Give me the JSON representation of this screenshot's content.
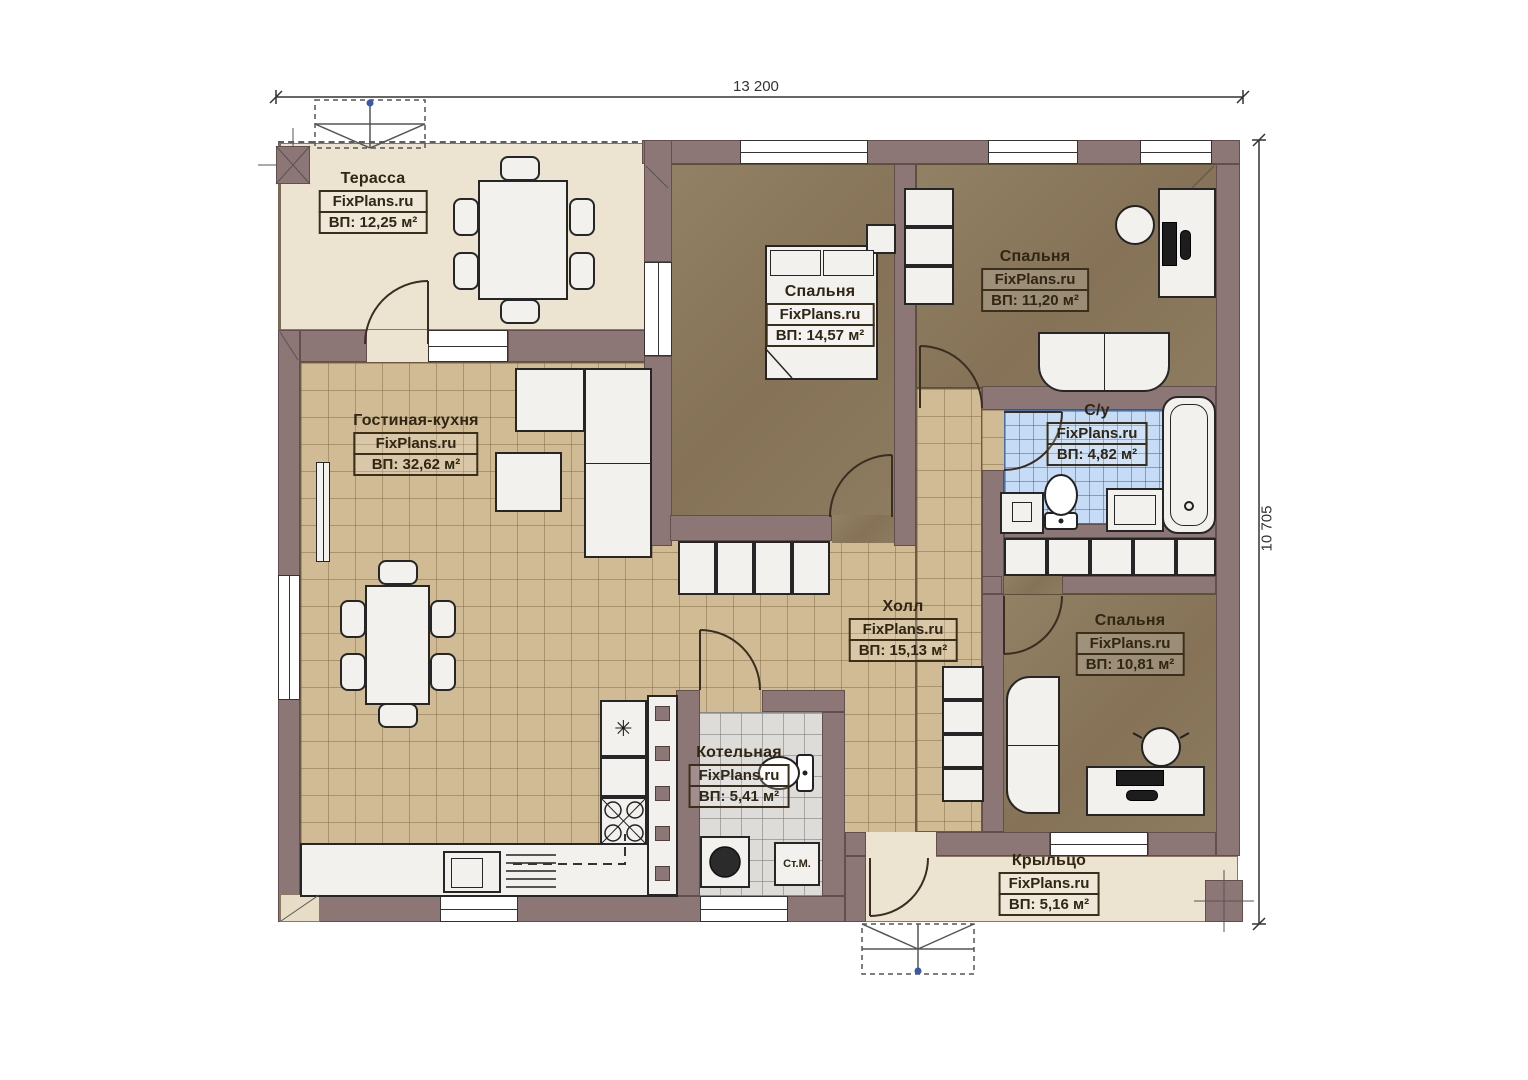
{
  "plan": {
    "watermark": "FixPlans.ru",
    "dimensions": {
      "width": "13 200",
      "height": "10 705"
    },
    "rooms": [
      {
        "key": "terrace",
        "name": "Терасса",
        "area": "ВП: 12,25 м²"
      },
      {
        "key": "living_kitchen",
        "name": "Гостиная-кухня",
        "area": "ВП: 32,62 м²"
      },
      {
        "key": "bedroom_1",
        "name": "Спальня",
        "area": "ВП: 14,57 м²"
      },
      {
        "key": "bedroom_2",
        "name": "Спальня",
        "area": "ВП: 11,20 м²"
      },
      {
        "key": "bathroom",
        "name": "С/у",
        "area": "ВП: 4,82 м²"
      },
      {
        "key": "hall",
        "name": "Холл",
        "area": "ВП: 15,13 м²"
      },
      {
        "key": "bedroom_3",
        "name": "Спальня",
        "area": "ВП: 10,81 м²"
      },
      {
        "key": "boiler_room",
        "name": "Котельная",
        "area": "ВП: 5,41 м²"
      },
      {
        "key": "porch",
        "name": "Крыльцо",
        "area": "ВП: 5,16 м²"
      }
    ],
    "annotations": {
      "washing_machine": "Ст.М."
    },
    "colors": {
      "wall": "#8d7676",
      "terrace_floor": "#ece3d0",
      "tile_floor": "#d1bb94",
      "bedroom_floor": "#8b7a5d",
      "bathroom_floor": "#c6dcf6",
      "boiler_floor": "#dddcd9"
    }
  }
}
